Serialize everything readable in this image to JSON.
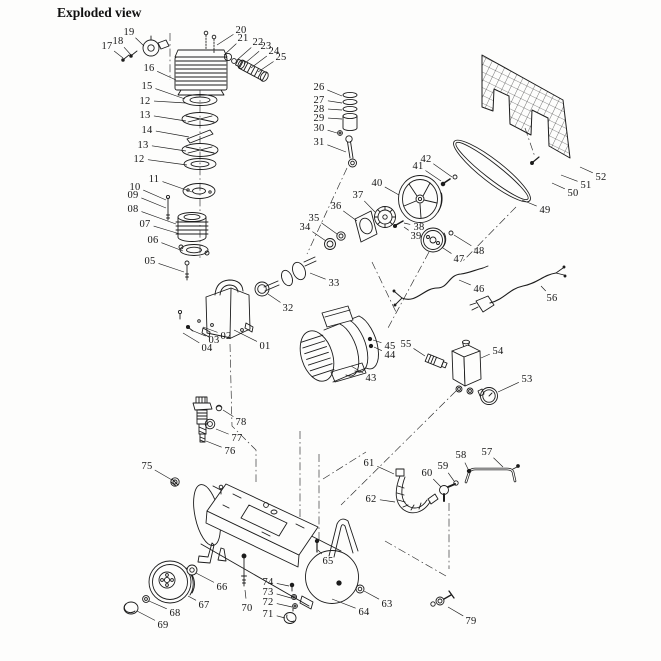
{
  "title": "Exploded view",
  "diagram": {
    "description": "Air compressor exploded parts diagram, numbered parts 01-79",
    "ink_color": "#1c1c1c",
    "background_color": "#fdfdfc",
    "labels": [
      {
        "text": "01",
        "x": 265,
        "y": 349,
        "tx": 234,
        "ty": 330
      },
      {
        "text": "02",
        "x": 226,
        "y": 339,
        "tx": 203,
        "ty": 327
      },
      {
        "text": "03",
        "x": 214,
        "y": 343,
        "tx": 191,
        "ty": 330
      },
      {
        "text": "04",
        "x": 207,
        "y": 351,
        "tx": 183,
        "ty": 333
      },
      {
        "text": "05",
        "x": 150,
        "y": 264,
        "tx": 184,
        "ty": 272
      },
      {
        "text": "06",
        "x": 153,
        "y": 243,
        "tx": 183,
        "ty": 251
      },
      {
        "text": "07",
        "x": 145,
        "y": 227,
        "tx": 180,
        "ty": 234
      },
      {
        "text": "08",
        "x": 133,
        "y": 212,
        "tx": 176,
        "ty": 224
      },
      {
        "text": "09",
        "x": 133,
        "y": 198,
        "tx": 166,
        "ty": 208
      },
      {
        "text": "10",
        "x": 135,
        "y": 190,
        "tx": 166,
        "ty": 200
      },
      {
        "text": "11",
        "x": 154,
        "y": 182,
        "tx": 192,
        "ty": 192
      },
      {
        "text": "12",
        "x": 139,
        "y": 162,
        "tx": 187,
        "ty": 165
      },
      {
        "text": "13",
        "x": 143,
        "y": 148,
        "tx": 186,
        "ty": 151
      },
      {
        "text": "14",
        "x": 147,
        "y": 133,
        "tx": 189,
        "ty": 137
      },
      {
        "text": "13",
        "x": 145,
        "y": 118,
        "tx": 186,
        "ty": 121
      },
      {
        "text": "12",
        "x": 145,
        "y": 104,
        "tx": 186,
        "ty": 103
      },
      {
        "text": "15",
        "x": 147,
        "y": 89,
        "tx": 185,
        "ty": 99
      },
      {
        "text": "16",
        "x": 149,
        "y": 71,
        "tx": 176,
        "ty": 80
      },
      {
        "text": "17",
        "x": 107,
        "y": 49,
        "tx": 123,
        "ty": 58
      },
      {
        "text": "18",
        "x": 118,
        "y": 44,
        "tx": 131,
        "ty": 55
      },
      {
        "text": "19",
        "x": 129,
        "y": 35,
        "tx": 144,
        "ty": 46
      },
      {
        "text": "20",
        "x": 241,
        "y": 33,
        "tx": 217,
        "ty": 45
      },
      {
        "text": "21",
        "x": 243,
        "y": 41,
        "tx": 224,
        "ty": 55
      },
      {
        "text": "22",
        "x": 258,
        "y": 45,
        "tx": 237,
        "ty": 60
      },
      {
        "text": "23",
        "x": 266,
        "y": 49,
        "tx": 244,
        "ty": 64
      },
      {
        "text": "24",
        "x": 274,
        "y": 54,
        "tx": 251,
        "ty": 68
      },
      {
        "text": "25",
        "x": 281,
        "y": 60,
        "tx": 258,
        "ty": 72
      },
      {
        "text": "26",
        "x": 319,
        "y": 90,
        "tx": 342,
        "ty": 96
      },
      {
        "text": "27",
        "x": 319,
        "y": 103,
        "tx": 342,
        "ty": 103
      },
      {
        "text": "28",
        "x": 319,
        "y": 112,
        "tx": 342,
        "ty": 110
      },
      {
        "text": "29",
        "x": 319,
        "y": 121,
        "tx": 342,
        "ty": 119
      },
      {
        "text": "30",
        "x": 319,
        "y": 131,
        "tx": 337,
        "ty": 133
      },
      {
        "text": "31",
        "x": 319,
        "y": 145,
        "tx": 346,
        "ty": 152
      },
      {
        "text": "32",
        "x": 288,
        "y": 311,
        "tx": 268,
        "ty": 294
      },
      {
        "text": "33",
        "x": 334,
        "y": 286,
        "tx": 310,
        "ty": 273
      },
      {
        "text": "34",
        "x": 305,
        "y": 230,
        "tx": 326,
        "ty": 241
      },
      {
        "text": "35",
        "x": 314,
        "y": 221,
        "tx": 337,
        "ty": 234
      },
      {
        "text": "36",
        "x": 336,
        "y": 209,
        "tx": 357,
        "ty": 221
      },
      {
        "text": "37",
        "x": 358,
        "y": 198,
        "tx": 375,
        "ty": 212
      },
      {
        "text": "38",
        "x": 419,
        "y": 230,
        "tx": 404,
        "ty": 223
      },
      {
        "text": "39",
        "x": 416,
        "y": 239,
        "tx": 404,
        "ty": 227
      },
      {
        "text": "40",
        "x": 377,
        "y": 186,
        "tx": 399,
        "ty": 195
      },
      {
        "text": "41",
        "x": 418,
        "y": 169,
        "tx": 441,
        "ty": 181
      },
      {
        "text": "42",
        "x": 426,
        "y": 162,
        "tx": 452,
        "ty": 177
      },
      {
        "text": "43",
        "x": 371,
        "y": 381,
        "tx": 351,
        "ty": 366
      },
      {
        "text": "44",
        "x": 390,
        "y": 358,
        "tx": 374,
        "ty": 347
      },
      {
        "text": "45",
        "x": 390,
        "y": 349,
        "tx": 373,
        "ty": 340
      },
      {
        "text": "46",
        "x": 479,
        "y": 292,
        "tx": 459,
        "ty": 280
      },
      {
        "text": "47",
        "x": 459,
        "y": 262,
        "tx": 443,
        "ty": 248
      },
      {
        "text": "48",
        "x": 479,
        "y": 254,
        "tx": 454,
        "ty": 235
      },
      {
        "text": "49",
        "x": 545,
        "y": 213,
        "tx": 522,
        "ty": 200
      },
      {
        "text": "50",
        "x": 573,
        "y": 196,
        "tx": 552,
        "ty": 183
      },
      {
        "text": "51",
        "x": 586,
        "y": 188,
        "tx": 561,
        "ty": 175
      },
      {
        "text": "52",
        "x": 601,
        "y": 180,
        "tx": 580,
        "ty": 167
      },
      {
        "text": "53",
        "x": 527,
        "y": 382,
        "tx": 498,
        "ty": 392
      },
      {
        "text": "54",
        "x": 498,
        "y": 354,
        "tx": 481,
        "ty": 358
      },
      {
        "text": "55",
        "x": 406,
        "y": 347,
        "tx": 425,
        "ty": 356
      },
      {
        "text": "56",
        "x": 552,
        "y": 301,
        "tx": 541,
        "ty": 286
      },
      {
        "text": "57",
        "x": 487,
        "y": 455,
        "tx": 503,
        "ty": 467
      },
      {
        "text": "58",
        "x": 461,
        "y": 458,
        "tx": 468,
        "ty": 469
      },
      {
        "text": "59",
        "x": 443,
        "y": 469,
        "tx": 454,
        "ty": 481
      },
      {
        "text": "60",
        "x": 427,
        "y": 476,
        "tx": 441,
        "ty": 487
      },
      {
        "text": "61",
        "x": 369,
        "y": 466,
        "tx": 394,
        "ty": 474
      },
      {
        "text": "62",
        "x": 371,
        "y": 502,
        "tx": 395,
        "ty": 502
      },
      {
        "text": "63",
        "x": 387,
        "y": 607,
        "tx": 364,
        "ty": 591
      },
      {
        "text": "64",
        "x": 364,
        "y": 615,
        "tx": 332,
        "ty": 599
      },
      {
        "text": "65",
        "x": 328,
        "y": 564,
        "tx": 318,
        "ty": 550
      },
      {
        "text": "66",
        "x": 222,
        "y": 590,
        "tx": 196,
        "ty": 573
      },
      {
        "text": "67",
        "x": 204,
        "y": 608,
        "tx": 188,
        "ty": 596
      },
      {
        "text": "68",
        "x": 175,
        "y": 616,
        "tx": 149,
        "ty": 601
      },
      {
        "text": "69",
        "x": 163,
        "y": 628,
        "tx": 137,
        "ty": 611
      },
      {
        "text": "70",
        "x": 247,
        "y": 611,
        "tx": 245,
        "ty": 590
      },
      {
        "text": "71",
        "x": 268,
        "y": 617,
        "tx": 285,
        "ty": 618
      },
      {
        "text": "72",
        "x": 268,
        "y": 605,
        "tx": 292,
        "ty": 607
      },
      {
        "text": "73",
        "x": 268,
        "y": 595,
        "tx": 291,
        "ty": 598
      },
      {
        "text": "74",
        "x": 268,
        "y": 585,
        "tx": 289,
        "ty": 586
      },
      {
        "text": "75",
        "x": 147,
        "y": 469,
        "tx": 172,
        "ty": 480
      },
      {
        "text": "76",
        "x": 230,
        "y": 454,
        "tx": 206,
        "ty": 441
      },
      {
        "text": "77",
        "x": 237,
        "y": 441,
        "tx": 216,
        "ty": 429
      },
      {
        "text": "78",
        "x": 241,
        "y": 425,
        "tx": 223,
        "ty": 410
      },
      {
        "text": "79",
        "x": 471,
        "y": 624,
        "tx": 448,
        "ty": 607
      }
    ]
  }
}
